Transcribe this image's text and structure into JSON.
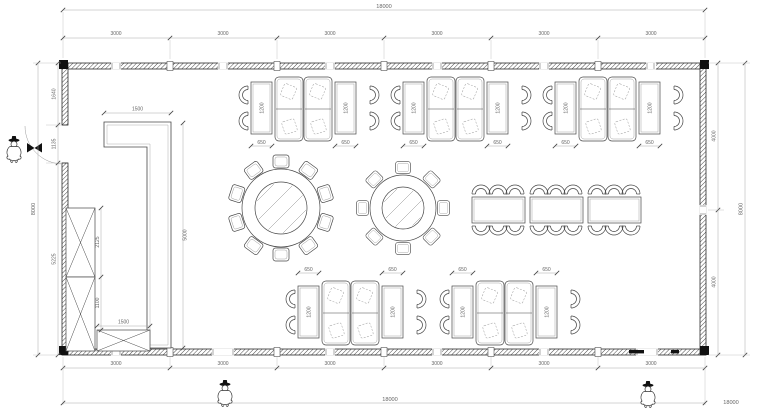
{
  "drawing": {
    "type": "restaurant-dining-room-floor-plan",
    "colors": {
      "line": "#2c2c2c",
      "furniture_line": "#474747",
      "dim_line": "#a8a8a8",
      "text": "#666666",
      "fill": "#ffffff"
    },
    "dimensions": {
      "top": {
        "overall": "18000",
        "segments": [
          "3000",
          "3000",
          "3000",
          "3000",
          "3000",
          "3000"
        ]
      },
      "bottom": {
        "overall": "18000",
        "segments": [
          "3000",
          "3000",
          "3000",
          "3000",
          "3000",
          "3000"
        ]
      },
      "left": {
        "overall": "8000",
        "segments": [
          "1640",
          "1135",
          "5225"
        ]
      },
      "right": {
        "overall": "8000",
        "segments": [
          "4000",
          "4000"
        ]
      },
      "counter": {
        "width": "1500",
        "length": "5000"
      },
      "cabinet": {
        "upper": "2125",
        "lower": "1100",
        "base": "1500"
      },
      "booth_table": {
        "length": "1200",
        "width": "650"
      }
    },
    "furniture": {
      "booth_groups_top": 3,
      "booth_groups_bottom": 2,
      "booth_group_contents": "2 side tables with 4 arch chairs + 2 double booth sofas",
      "round_table_large_seats": 10,
      "round_table_small_seats": 8,
      "banquet_tables": 3,
      "banquet_chairs_per_table": 6,
      "bar_counter": "L-shaped",
      "wall_cabinets": 3,
      "entrance_figures": 3
    }
  }
}
